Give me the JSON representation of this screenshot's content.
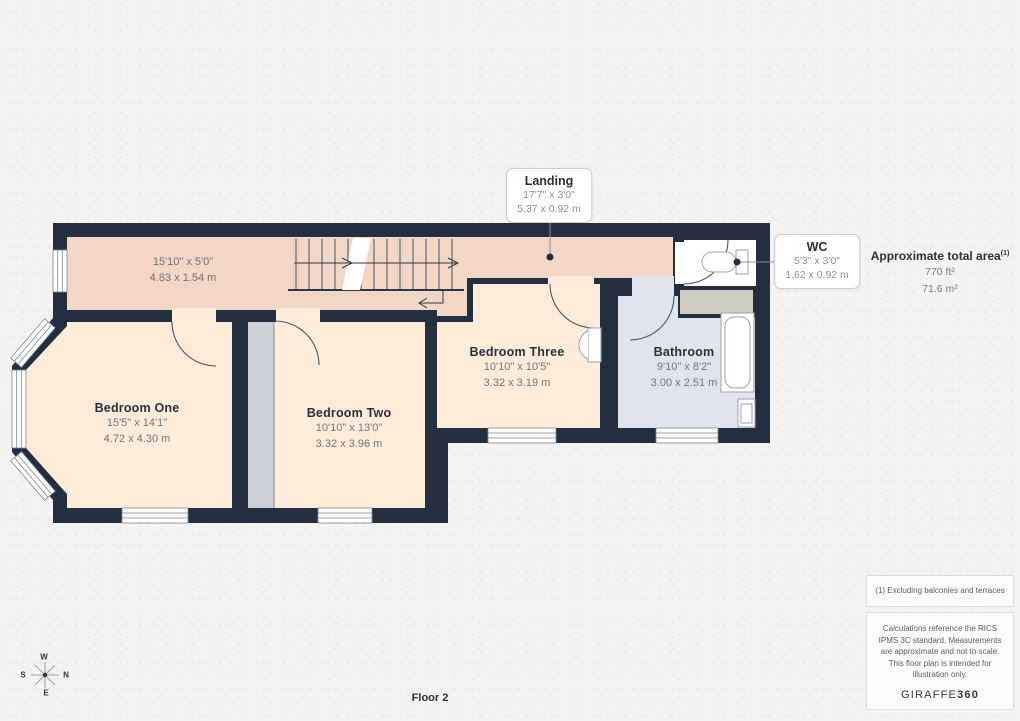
{
  "floor_label": "Floor 2",
  "rooms": [
    {
      "name": "Bedroom One",
      "dims_imperial": "15'5\" x 14'1\"",
      "dims_metric": "4.72 x 4.30 m"
    },
    {
      "name": "Bedroom Two",
      "dims_imperial": "10'10\" x 13'0\"",
      "dims_metric": "3.32 x 3.96 m"
    },
    {
      "name": "Bedroom Three",
      "dims_imperial": "10'10\" x 10'5\"",
      "dims_metric": "3.32 x 3.19 m"
    },
    {
      "name": "Bathroom",
      "dims_imperial": "9'10\" x 8'2\"",
      "dims_metric": "3.00 x 2.51 m"
    }
  ],
  "area_labels": {
    "landing_strip": {
      "dims_imperial": "15'10\" x 5'0\"",
      "dims_metric": "4.83 x 1.54 m"
    }
  },
  "callouts": [
    {
      "name": "Landing",
      "dims_imperial": "17'7\" x 3'0\"",
      "dims_metric": "5.37 x 0.92 m"
    },
    {
      "name": "WC",
      "dims_imperial": "5'3\" x 3'0\"",
      "dims_metric": "1.62 x 0.92 m"
    }
  ],
  "sidebar": {
    "total_area_title": "Approximate total area",
    "total_area_sup": "(1)",
    "total_area_ft": "770 ft²",
    "total_area_m": "71.6 m²",
    "footnote": "(1) Excluding balconies and terraces",
    "disclaimer": "Calculations reference the RICS IPMS 3C standard. Measurements are approximate and not to scale. This floor plan is intended for illustration only.",
    "brand": {
      "name_regular": "GIRAFFE",
      "name_bold": "360"
    }
  },
  "compass": {
    "n": "N",
    "e": "E",
    "s": "S",
    "w": "W"
  },
  "colors": {
    "wall": "#232e3f",
    "landing": "#f2d7c6",
    "bedroom": "#fdecd9",
    "bathroom": "#dfe4ee",
    "wc": "#ffffff",
    "cupboard": "#d0ccc4",
    "wardrobe": "#cdd1d7",
    "canvas": "#f3f3f2"
  }
}
